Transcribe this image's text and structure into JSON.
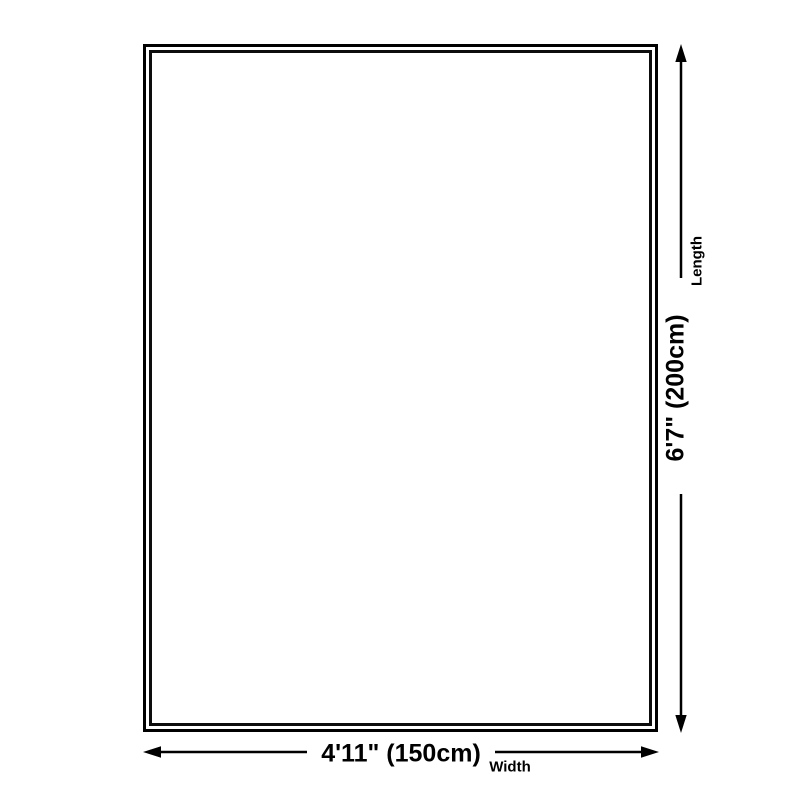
{
  "diagram": {
    "type": "product-dimensions",
    "shape": "rectangle",
    "colors": {
      "background": "#ffffff",
      "ink": "#000000"
    },
    "dimensions": {
      "length": {
        "value": "6'7\" (200cm)",
        "label": "Length",
        "orientation": "vertical"
      },
      "width": {
        "value": "4'11\" (150cm)",
        "label": "Width",
        "orientation": "horizontal"
      }
    }
  }
}
